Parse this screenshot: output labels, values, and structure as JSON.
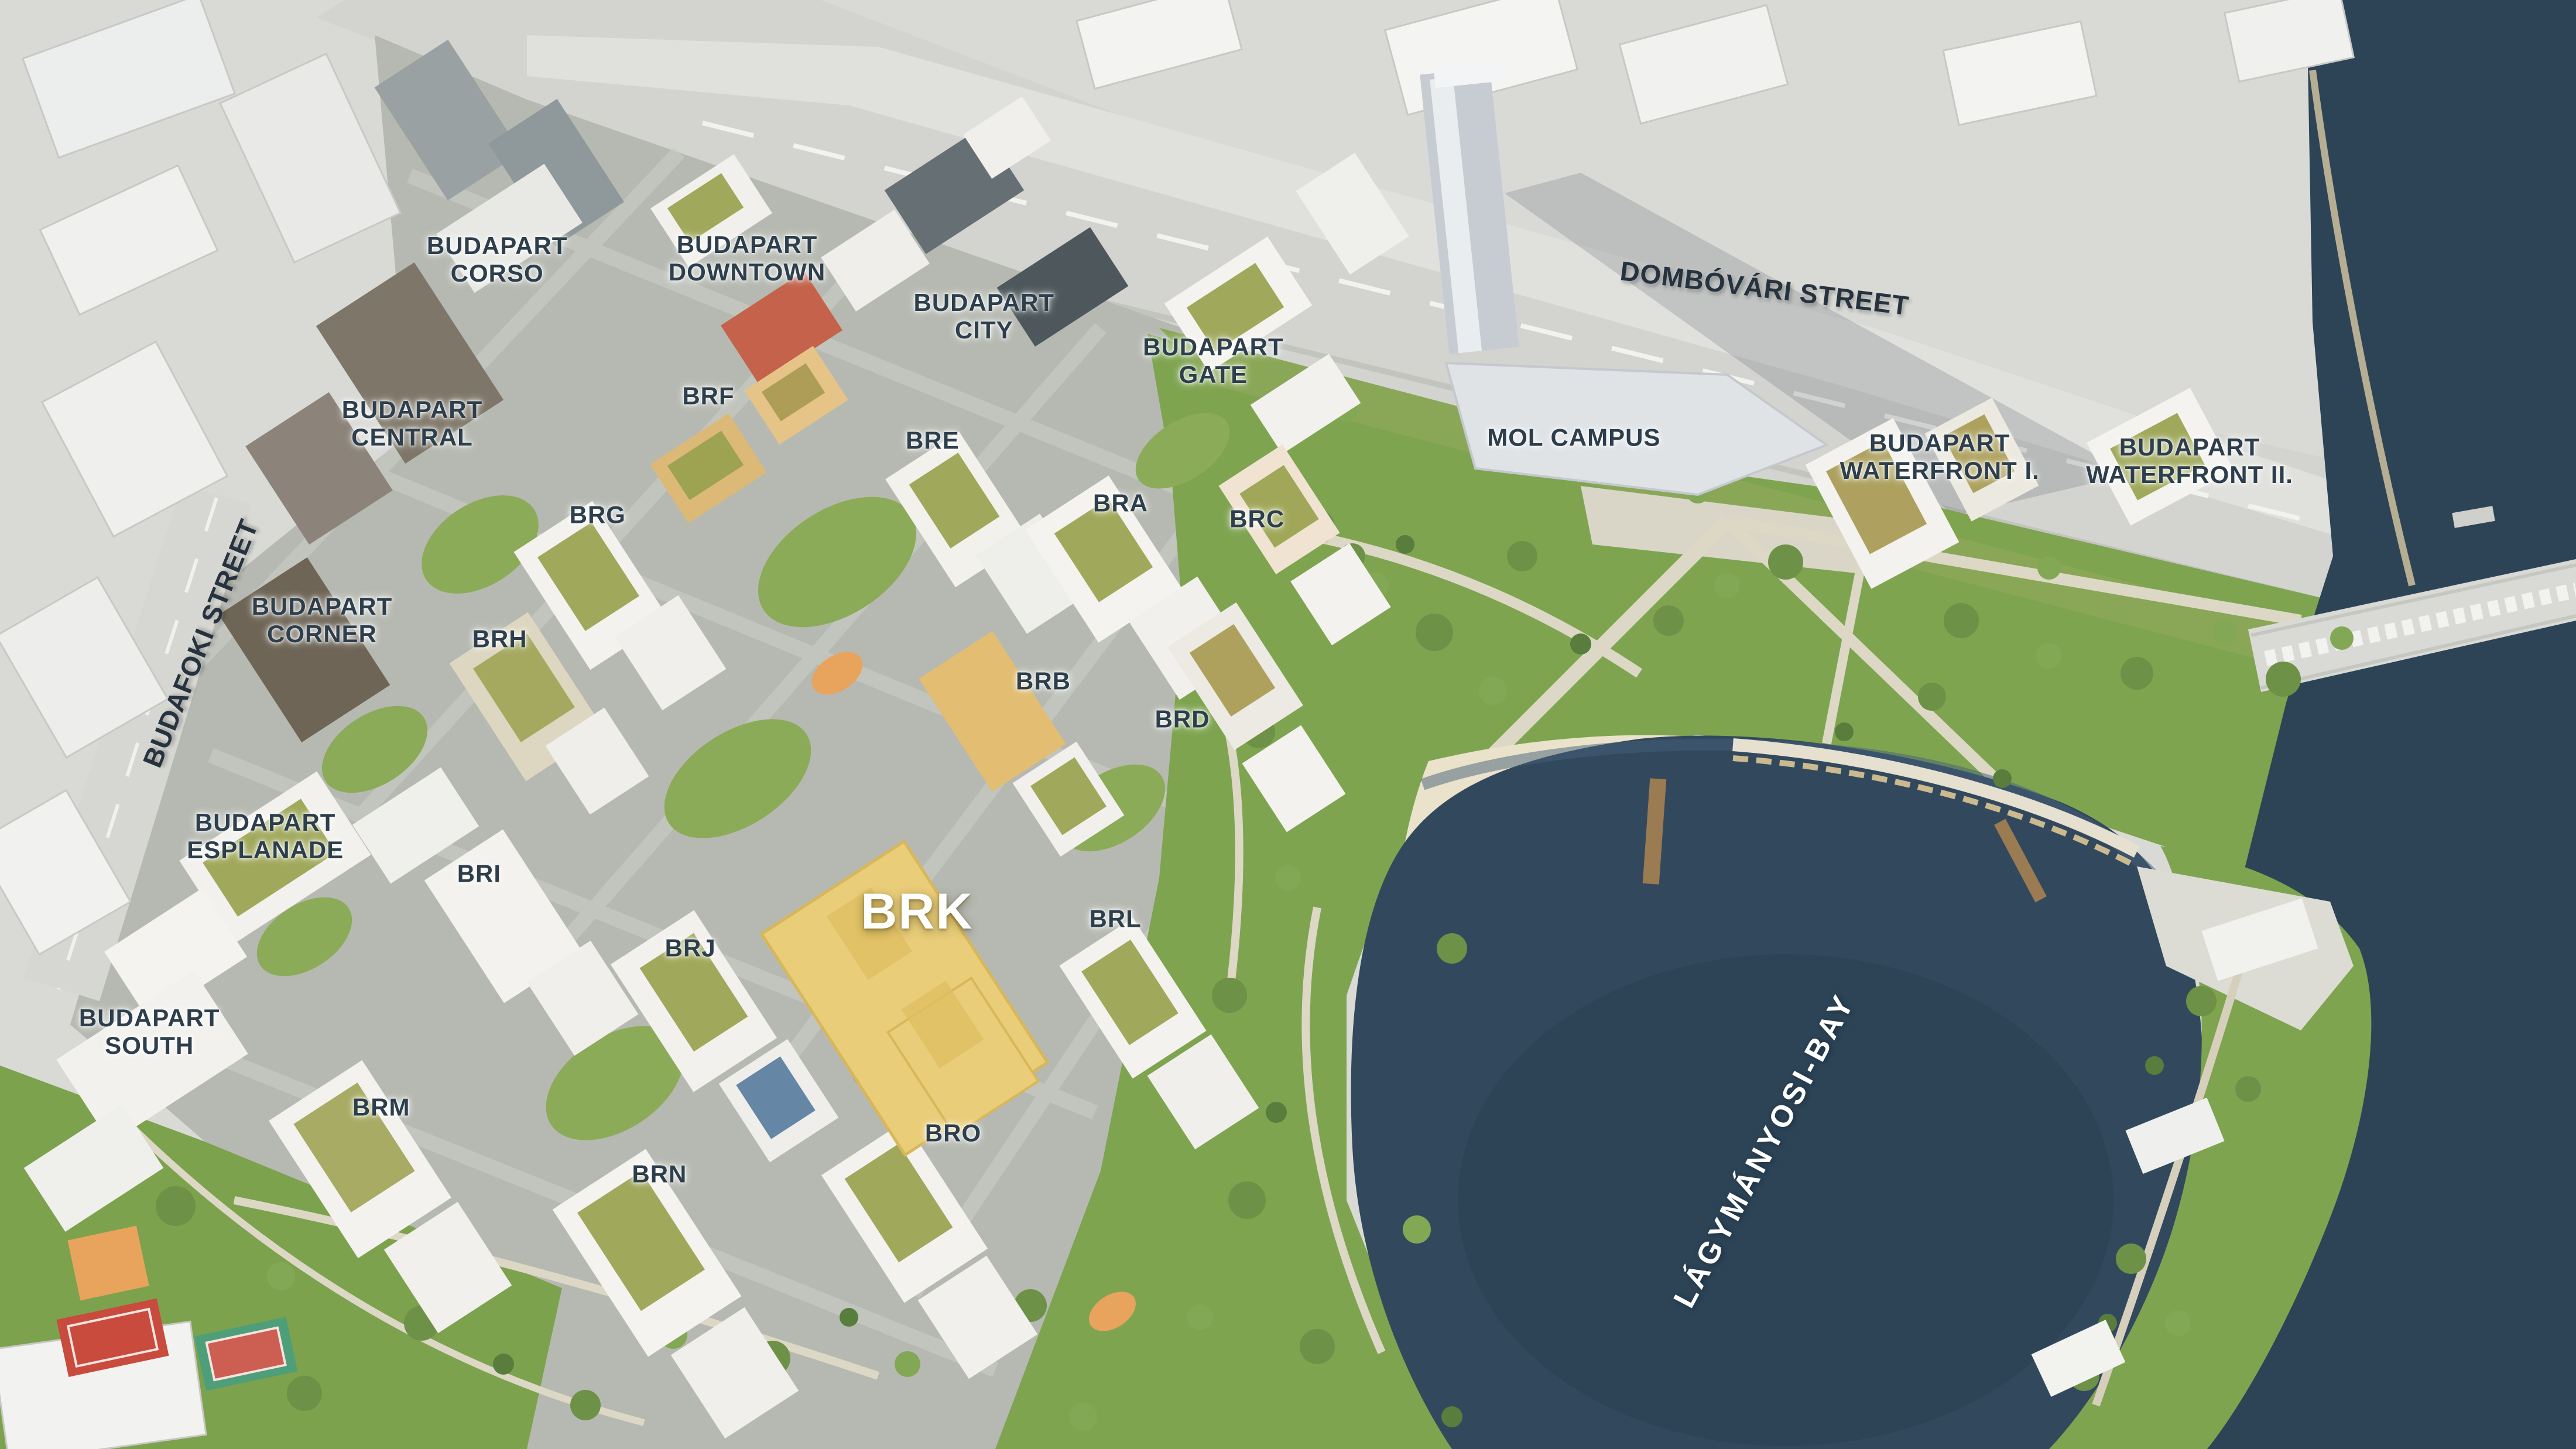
{
  "map": {
    "colors": {
      "bay_water": "#32495d",
      "river_water": "#2d4356",
      "park_green": "#7ea450",
      "beach_sand": "#eae2cb",
      "paving": "#b7bab2",
      "pale_city": "#d9dad5",
      "road_band": "#d5d6d1",
      "highlight_building": "#e9cd79",
      "label_dark": "#2d3e4c",
      "label_light": "#ffffff"
    },
    "labels": [
      {
        "id": "budapart-corso",
        "text": "BUDAPART\nCORSO",
        "x": 19.3,
        "y": 17.9,
        "rot": 0,
        "variant": "district"
      },
      {
        "id": "budapart-downtown",
        "text": "BUDAPART\nDOWNTOWN",
        "x": 29.0,
        "y": 17.8,
        "rot": 0,
        "variant": "district"
      },
      {
        "id": "budapart-city",
        "text": "BUDAPART\nCITY",
        "x": 38.2,
        "y": 21.8,
        "rot": 0,
        "variant": "district"
      },
      {
        "id": "budapart-gate",
        "text": "BUDAPART\nGATE",
        "x": 47.1,
        "y": 24.9,
        "rot": 0,
        "variant": "district"
      },
      {
        "id": "budapart-central",
        "text": "BUDAPART\nCENTRAL",
        "x": 16.0,
        "y": 29.2,
        "rot": 0,
        "variant": "district"
      },
      {
        "id": "mol-campus",
        "text": "MOL CAMPUS",
        "x": 61.1,
        "y": 30.2,
        "rot": 0,
        "variant": "district"
      },
      {
        "id": "budapart-waterfront-1",
        "text": "BUDAPART\nWATERFRONT I.",
        "x": 75.3,
        "y": 31.5,
        "rot": 0,
        "variant": "district"
      },
      {
        "id": "budapart-waterfront-2",
        "text": "BUDAPART\nWATERFRONT II.",
        "x": 85.0,
        "y": 31.8,
        "rot": 0,
        "variant": "district"
      },
      {
        "id": "budapart-corner",
        "text": "BUDAPART\nCORNER",
        "x": 12.5,
        "y": 42.8,
        "rot": 0,
        "variant": "district"
      },
      {
        "id": "budapart-esplanade",
        "text": "BUDAPART\nESPLANADE",
        "x": 10.3,
        "y": 57.7,
        "rot": 0,
        "variant": "district"
      },
      {
        "id": "budapart-south",
        "text": "BUDAPART\nSOUTH",
        "x": 5.8,
        "y": 71.2,
        "rot": 0,
        "variant": "district"
      },
      {
        "id": "brf",
        "text": "BRF",
        "x": 27.5,
        "y": 27.3,
        "rot": 0,
        "variant": "code"
      },
      {
        "id": "bre",
        "text": "BRE",
        "x": 36.2,
        "y": 30.4,
        "rot": 0,
        "variant": "code"
      },
      {
        "id": "brg",
        "text": "BRG",
        "x": 23.2,
        "y": 35.5,
        "rot": 0,
        "variant": "code"
      },
      {
        "id": "bra",
        "text": "BRA",
        "x": 43.5,
        "y": 34.7,
        "rot": 0,
        "variant": "code"
      },
      {
        "id": "brc",
        "text": "BRC",
        "x": 48.8,
        "y": 35.8,
        "rot": 0,
        "variant": "code"
      },
      {
        "id": "brh",
        "text": "BRH",
        "x": 19.4,
        "y": 44.1,
        "rot": 0,
        "variant": "code"
      },
      {
        "id": "brb",
        "text": "BRB",
        "x": 40.5,
        "y": 47.0,
        "rot": 0,
        "variant": "code"
      },
      {
        "id": "brd",
        "text": "BRD",
        "x": 45.9,
        "y": 49.6,
        "rot": 0,
        "variant": "code"
      },
      {
        "id": "bri",
        "text": "BRI",
        "x": 18.6,
        "y": 60.3,
        "rot": 0,
        "variant": "code"
      },
      {
        "id": "brk",
        "text": "BRK",
        "x": 35.6,
        "y": 62.9,
        "rot": 0,
        "variant": "highlight"
      },
      {
        "id": "brl",
        "text": "BRL",
        "x": 43.3,
        "y": 63.4,
        "rot": 0,
        "variant": "code"
      },
      {
        "id": "brj",
        "text": "BRJ",
        "x": 26.8,
        "y": 65.4,
        "rot": 0,
        "variant": "code"
      },
      {
        "id": "brm",
        "text": "BRM",
        "x": 14.8,
        "y": 76.4,
        "rot": 0,
        "variant": "code"
      },
      {
        "id": "bro",
        "text": "BRO",
        "x": 37.0,
        "y": 78.2,
        "rot": 0,
        "variant": "code"
      },
      {
        "id": "brn",
        "text": "BRN",
        "x": 25.6,
        "y": 81.0,
        "rot": 0,
        "variant": "code"
      },
      {
        "id": "dombovari-street",
        "text": "DOMBÓVÁRI STREET",
        "x": 68.5,
        "y": 19.9,
        "rot": 7,
        "variant": "street"
      },
      {
        "id": "budafoki-street",
        "text": "BUDAFOKI STREET",
        "x": 7.8,
        "y": 44.4,
        "rot": -68,
        "variant": "street"
      },
      {
        "id": "lagymanyosi-bay",
        "text": "LÁGYMÁNYOSI-BAY",
        "x": 68.5,
        "y": 79.4,
        "rot": -62,
        "variant": "water"
      }
    ]
  }
}
